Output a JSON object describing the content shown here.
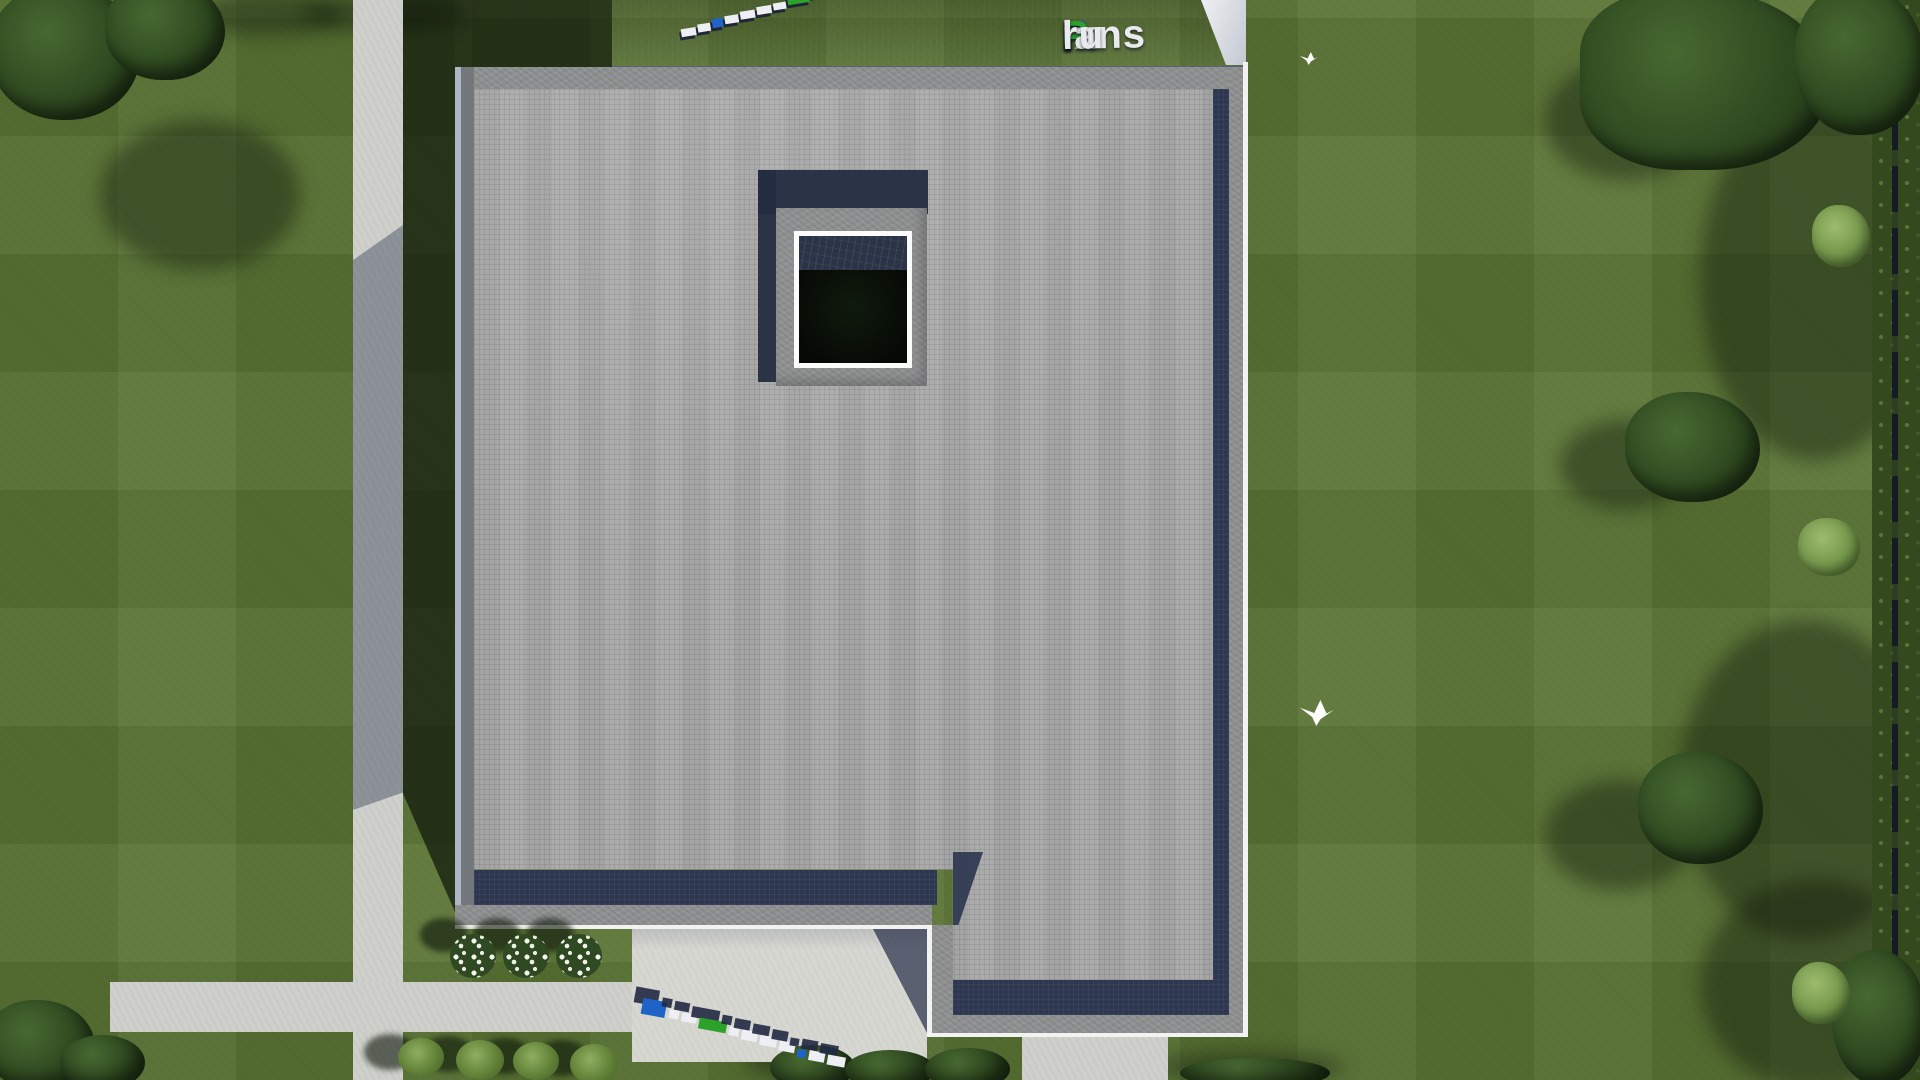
{
  "brand": {
    "name": "FixPlans.ru",
    "parts": {
      "f": "F",
      "ix": "ix",
      "p": "P",
      "lans": "lans",
      "dot": ".",
      "ru": "ru"
    },
    "colors": {
      "blue": "#1f63c8",
      "green": "#2ba32b",
      "white": "#edeff4"
    }
  },
  "scene": {
    "type": "3d-aerial-architectural-render",
    "subject": "flat-roof house, top-down roof plan view",
    "watermark_instances": [
      {
        "id": "top-right-text",
        "text": "FixPlans.ru",
        "style": "flat-colored-text"
      },
      {
        "id": "top-left-3d",
        "text": "FixPlans.ru",
        "style": "3d-blocks-mirrored"
      },
      {
        "id": "bottom-patio-3d",
        "text": "FixPlans.ru",
        "style": "3d-blocks"
      }
    ],
    "palette": {
      "grass": "#5a7434",
      "grass_shadow": "#24330f",
      "roof_field": "#a9a9a9",
      "roof_navy_band": "#2e3750",
      "parapet_concrete": "#8e9091",
      "upper_structure": "#3d4660",
      "walkway": "#cfd0cb",
      "patio": "#d7d7d2",
      "skylight_frame": "#fbfbfb",
      "skylight_interior": "#0b100b",
      "hedge": "#35491f",
      "flower_white": "#f4f6ee"
    }
  }
}
